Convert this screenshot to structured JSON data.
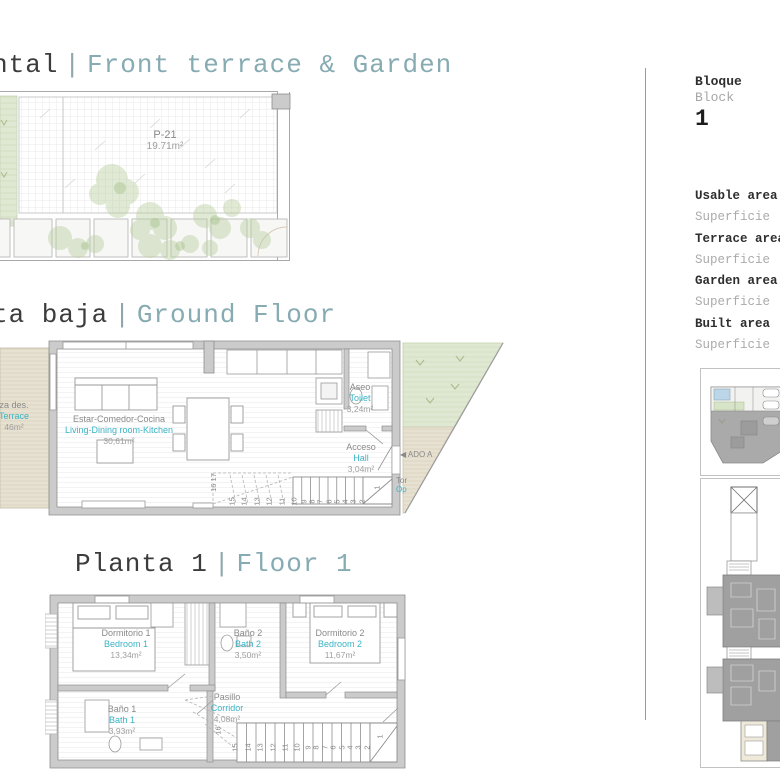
{
  "headings": {
    "garden": {
      "left": "ntal",
      "sep": "|",
      "right": "Front terrace & Garden"
    },
    "ground": {
      "left": "ta baja",
      "sep": "|",
      "right": "Ground Floor"
    },
    "floor1": {
      "left": "Planta 1",
      "sep": "|",
      "right": "Floor 1"
    }
  },
  "garden": {
    "plot": "P-21",
    "plot_area": "19.71m²"
  },
  "ground": {
    "living": {
      "es": "Estar-Comedor-Cocina",
      "en": "Living-Dining room-Kitchen",
      "area": "30,61m²"
    },
    "aseo": {
      "es": "Aseo",
      "en": "Toilet",
      "area": "3,24m²"
    },
    "acceso": {
      "es": "Acceso",
      "en": "Hall",
      "area": "3,04m²"
    },
    "terrace": {
      "es": "za des.",
      "en": "Terrace",
      "area": "46m²"
    },
    "wedge": {
      "arrow_label": "◀ ADO A",
      "partial_es": "Tor",
      "partial_en": "Op"
    },
    "stairs": {
      "numbers": [
        "15",
        "14",
        "13",
        "12",
        "11",
        "10",
        "9",
        "8",
        "7",
        "6",
        "5",
        "4",
        "3",
        "2"
      ],
      "first": "1",
      "upper": "16 17"
    }
  },
  "floor1": {
    "bedroom1": {
      "es": "Dormitorio 1",
      "en": "Bedroom 1",
      "area": "13,34m²"
    },
    "bath2": {
      "es": "Baño 2",
      "en": "Bath 2",
      "area": "3,50m²"
    },
    "bedroom2": {
      "es": "Dormitorio 2",
      "en": "Bedroom 2",
      "area": "11,67m²"
    },
    "bath1": {
      "es": "Baño 1",
      "en": "Bath 1",
      "area": "3,93m²"
    },
    "corridor": {
      "es": "Pasillo",
      "en": "Corridor",
      "area": "4,08m²"
    },
    "stairs": {
      "numbers": [
        "15",
        "14",
        "13",
        "12",
        "11",
        "10",
        "9",
        "8",
        "7",
        "6",
        "5",
        "4",
        "3",
        "2"
      ],
      "first": "1",
      "upper": "16"
    }
  },
  "sidebar": {
    "block": {
      "es": "Bloque",
      "en": "Block",
      "number": "1"
    },
    "areas": [
      {
        "en": "Usable area",
        "es": "Superficie"
      },
      {
        "en": "Terrace area",
        "es": "Superficie"
      },
      {
        "en": "Garden area",
        "es": "Superficie"
      },
      {
        "en": "Built area",
        "es": "Superficie"
      }
    ]
  },
  "colors": {
    "accent_cyan": "#3ab4c5",
    "heading_teal": "#87abb2",
    "label_gray": "#8a8a8a",
    "wall_gray": "#cbcbcb",
    "garden_green": "#dfe8d2",
    "terrace_tan": "#e7e1d1"
  }
}
